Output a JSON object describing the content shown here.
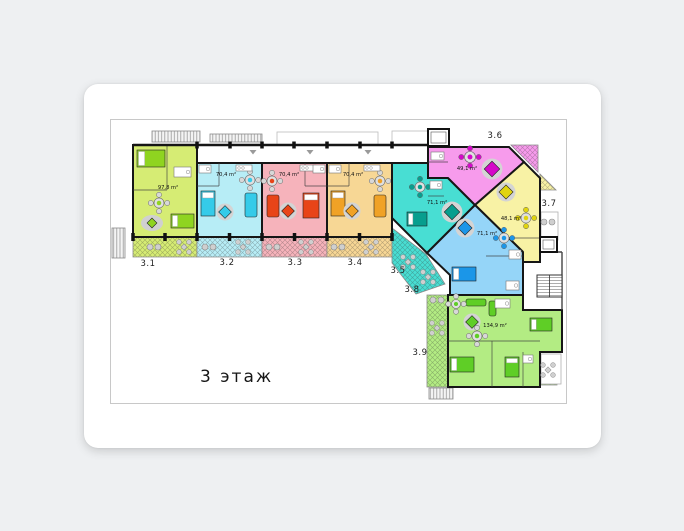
{
  "floor_label": "3 этаж",
  "plan": {
    "apartments": [
      {
        "id": "3.1",
        "area": "97,8 m²",
        "base": "#d6ec74",
        "accent": "#8fd420"
      },
      {
        "id": "3.2",
        "area": "70,4 m²",
        "base": "#b7edf6",
        "accent": "#35cbe9"
      },
      {
        "id": "3.3",
        "area": "70,4 m²",
        "base": "#f6b3bb",
        "accent": "#e84418"
      },
      {
        "id": "3.4",
        "area": "70,4 m²",
        "base": "#f7d795",
        "accent": "#f0a226"
      },
      {
        "id": "3.5",
        "area": "71,1 m²",
        "base": "#48ded3",
        "accent": "#079e8e"
      },
      {
        "id": "3.6",
        "area": "49,1 m²",
        "base": "#f79bec",
        "accent": "#d508c9"
      },
      {
        "id": "3.7",
        "area": "48,1 m²",
        "base": "#f8f2a5",
        "accent": "#e0d40e"
      },
      {
        "id": "3.8",
        "area": "71,1 m²",
        "base": "#95d5f8",
        "accent": "#1b96e8"
      },
      {
        "id": "3.9",
        "area": "134,9 m²",
        "base": "#b3ec83",
        "accent": "#5fce26"
      }
    ],
    "colors": {
      "wall": "#161616",
      "frame": "#c8c8c8",
      "card": "#ffffff",
      "page": "#eef0f2"
    }
  }
}
